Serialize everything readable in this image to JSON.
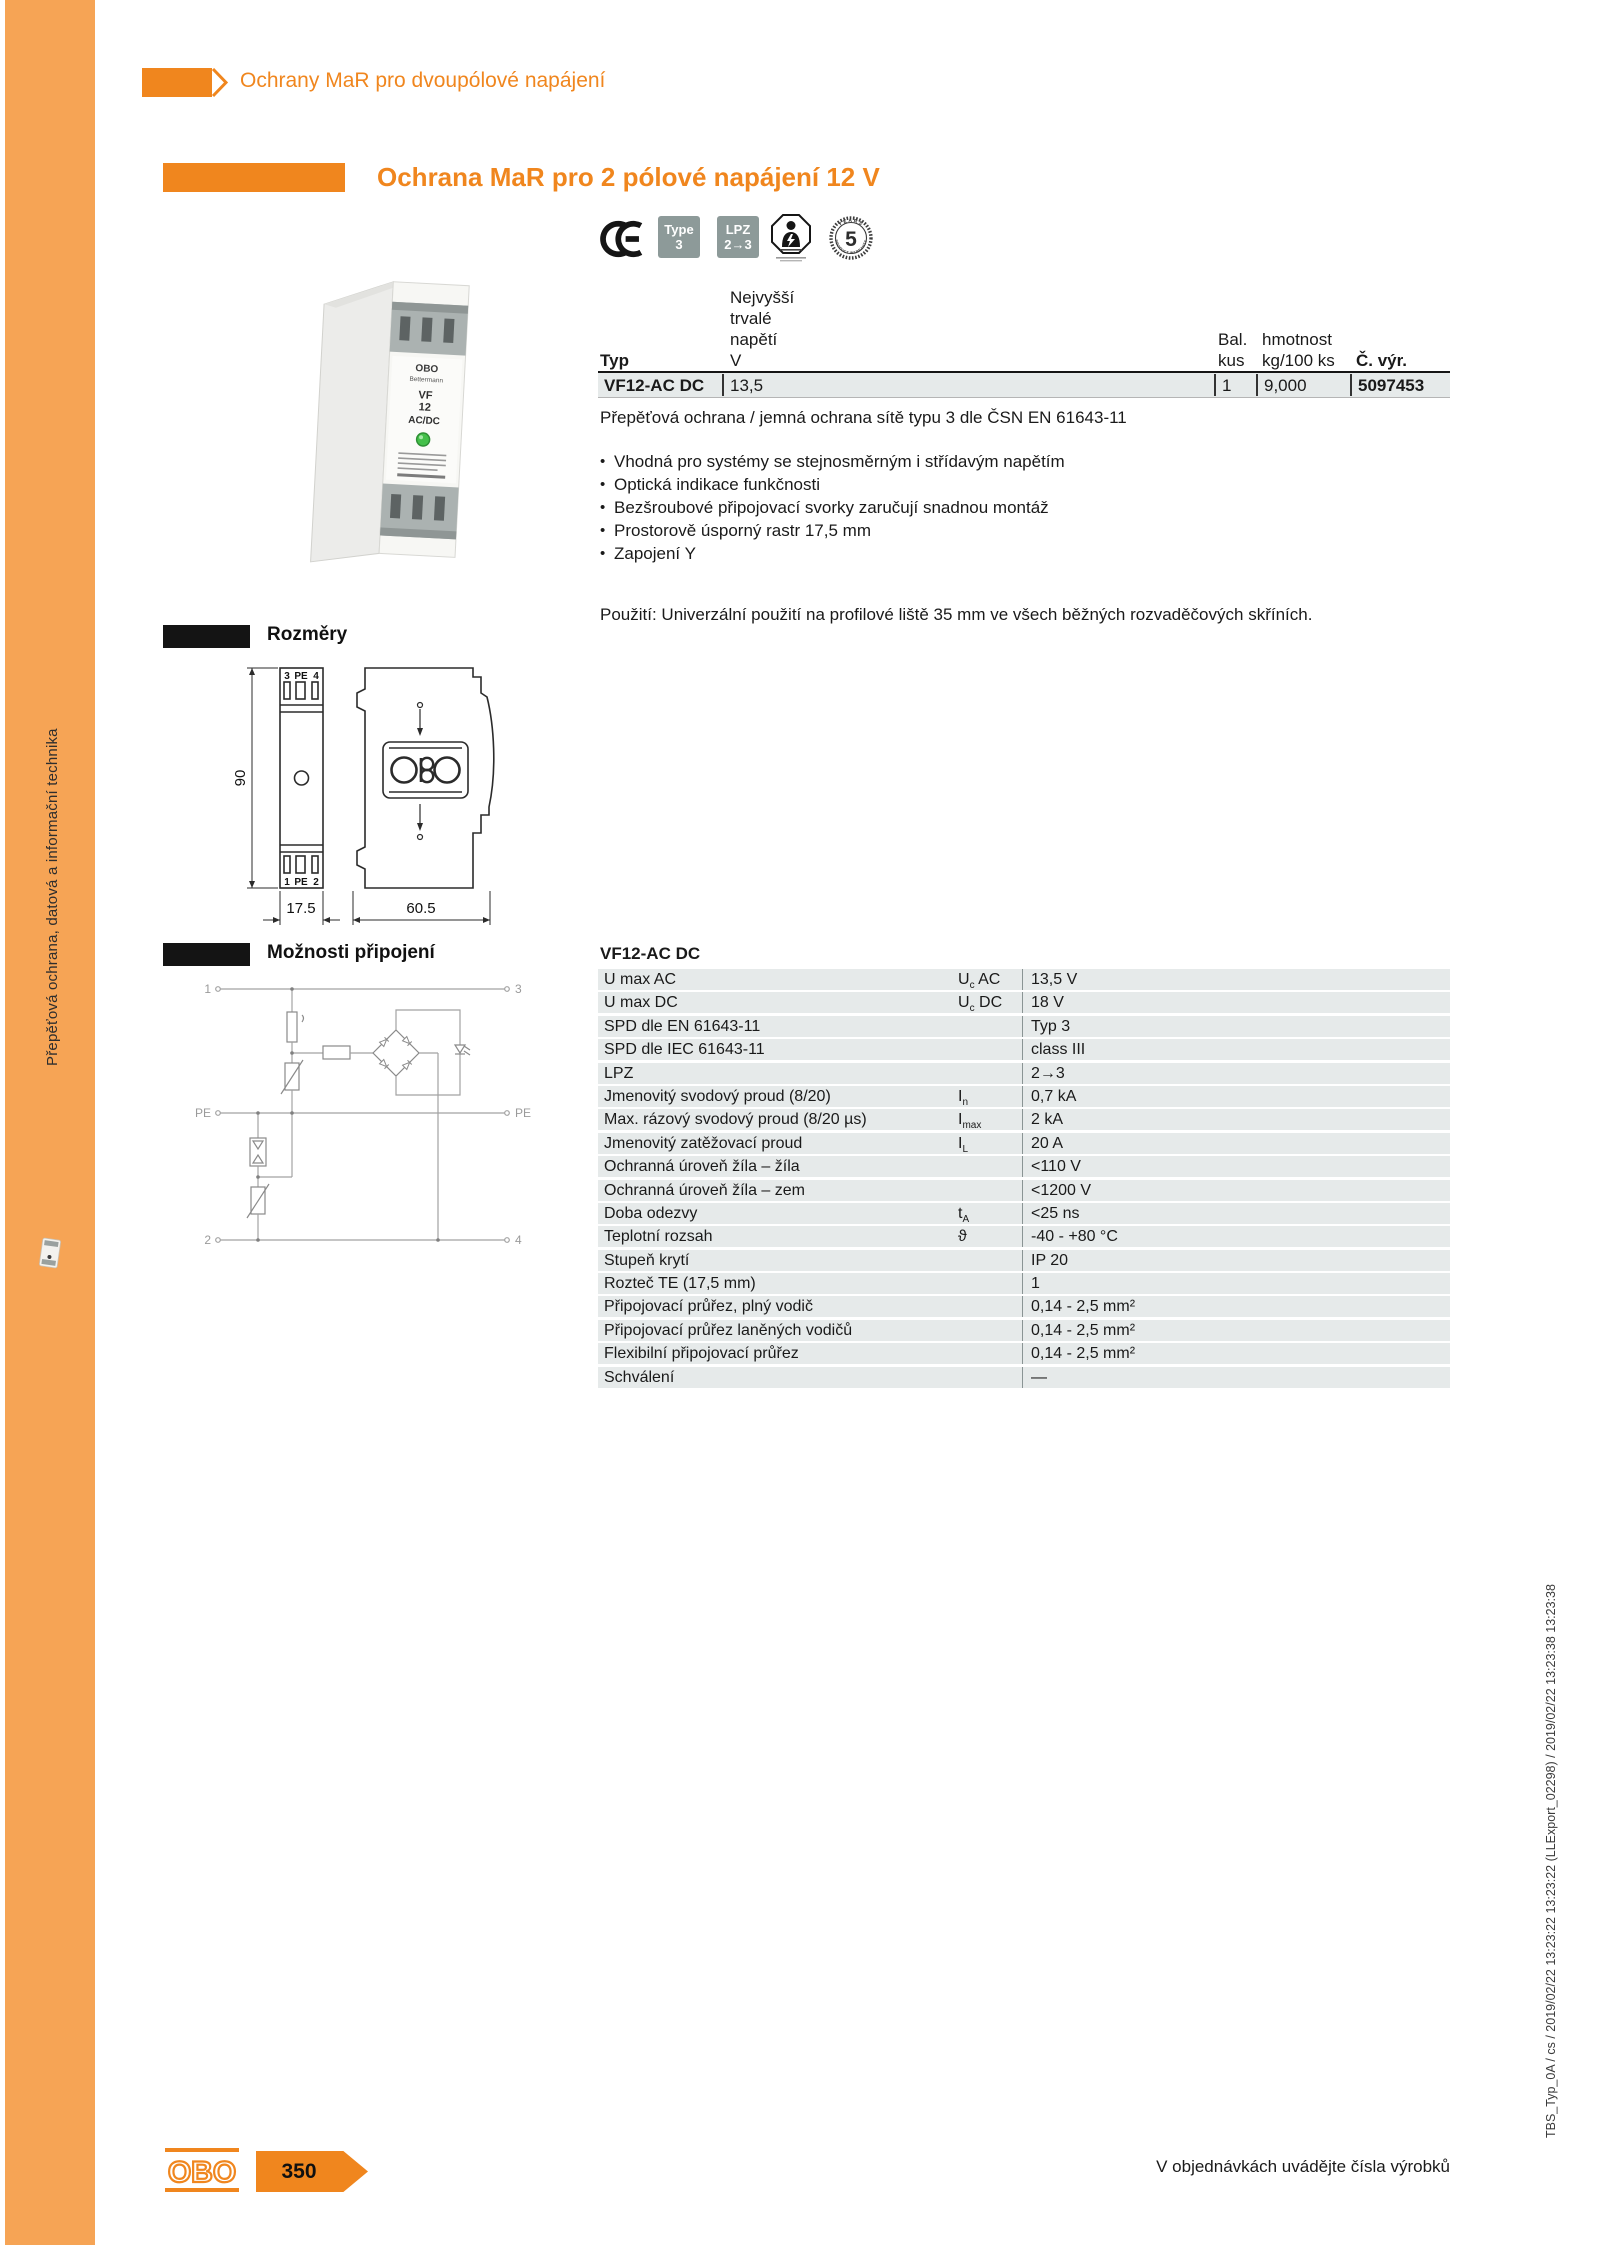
{
  "sidebar": {
    "vertical_text": "Přepěťová ochrana, datová a informační technika"
  },
  "header": {
    "category": "Ochrany MaR pro dvoupólové napájení"
  },
  "title": {
    "text": "Ochrana MaR pro 2 pólové napájení 12 V"
  },
  "badges": {
    "type": {
      "line1": "Type",
      "line2": "3"
    },
    "lpz": {
      "line1": "LPZ",
      "line2": "2→3"
    },
    "warranty": {
      "number": "5",
      "top": "YEARS",
      "bottom": "PRODUCT WARRANTY"
    }
  },
  "device": {
    "brand": "OBO",
    "name": "Bettermann",
    "model_line1": "VF",
    "model_line2": "12",
    "model_line3": "AC/DC"
  },
  "product_table": {
    "col_typ": "Typ",
    "col_voltage_lines": [
      "Nejvyšší",
      "trvalé",
      "napětí",
      "V"
    ],
    "col_bal_line1": "Bal.",
    "col_bal_line2": "kus",
    "col_weight_line1": "hmotnost",
    "col_weight_line2": "kg/100 ks",
    "col_artno": "Č. výr.",
    "row": {
      "typ": "VF12-AC DC",
      "voltage": "13,5",
      "bal": "1",
      "weight": "9,000",
      "artno": "5097453"
    }
  },
  "description": {
    "intro": "Přepěťová ochrana / jemná ochrana sítě typu 3 dle ČSN EN 61643-11",
    "bullets": [
      "Vhodná pro systémy se stejnosměrným i střídavým napětím",
      "Optická indikace funkčnosti",
      "Bezšroubové připojovací svorky zaručují snadnou montáž",
      "Prostorově úsporný rastr 17,5 mm",
      "Zapojení Y"
    ],
    "usage": "Použití: Univerzální použití na profilové liště 35 mm ve všech běžných rozvaděčových skříních."
  },
  "dimensions": {
    "heading": "Rozměry",
    "height": "90",
    "width": "17.5",
    "depth": "60.5",
    "t3": "3",
    "tpe": "PE",
    "t4": "4",
    "b1": "1",
    "bpe": "PE",
    "b2": "2"
  },
  "connection": {
    "heading": "Možnosti připojení",
    "t1": "1",
    "t2": "2",
    "t3": "3",
    "t4": "4",
    "pe_left": "PE",
    "pe_right": "PE"
  },
  "specs": {
    "heading": "VF12-AC DC",
    "rows": [
      {
        "label": "U max AC",
        "sym": "U",
        "sub": "c",
        "sym2": " AC",
        "value": "13,5 V"
      },
      {
        "label": "U max DC",
        "sym": "U",
        "sub": "c",
        "sym2": " DC",
        "value": "18 V"
      },
      {
        "label": "SPD dle EN 61643-11",
        "value": "Typ 3"
      },
      {
        "label": "SPD dle IEC 61643-11",
        "value": "class III"
      },
      {
        "label": "LPZ",
        "value": "2→3"
      },
      {
        "label": "Jmenovitý svodový proud (8/20)",
        "sym": "I",
        "sub": "n",
        "value": "0,7 kA"
      },
      {
        "label": "Max. rázový svodový proud (8/20 µs)",
        "sym": "I",
        "sub": "max",
        "value": "2 kA"
      },
      {
        "label": "Jmenovitý zatěžovací proud",
        "sym": "I",
        "sub": "L",
        "value": "20 A"
      },
      {
        "label": "Ochranná úroveň žíla – žíla",
        "value": "<110 V"
      },
      {
        "label": "Ochranná úroveň žíla – zem",
        "value": "<1200 V"
      },
      {
        "label": "Doba odezvy",
        "sym": "t",
        "sub": "A",
        "value": "<25 ns"
      },
      {
        "label": "Teplotní rozsah",
        "sym": "ϑ",
        "value": "-40 - +80 °C"
      },
      {
        "label": "Stupeň krytí",
        "value": "IP 20"
      },
      {
        "label": "Rozteč TE (17,5 mm)",
        "value": "1"
      },
      {
        "label": "Připojovací průřez, plný vodič",
        "value": "0,14 - 2,5 mm²"
      },
      {
        "label": "Připojovací průřez laněných vodičů",
        "value": "0,14 - 2,5 mm²"
      },
      {
        "label": "Flexibilní připojovací průřez",
        "value": "0,14 - 2,5 mm²"
      },
      {
        "label": "Schválení",
        "value": "—"
      }
    ]
  },
  "footer": {
    "logo": "OBO",
    "page": "350",
    "note": "V objednávkách uvádějte čísla výrobků"
  },
  "print_info": "TBS_Typ_0A / cs / 2019/02/22 13:23:22 13:23:22 (LLExport_02298) / 2019/02/22 13:23:38 13:23:38",
  "colors": {
    "accent": "#F0861E",
    "sidebar": "#F6A455",
    "row_gray": "#E6EAEA",
    "badge_gray": "#8D9A99"
  }
}
